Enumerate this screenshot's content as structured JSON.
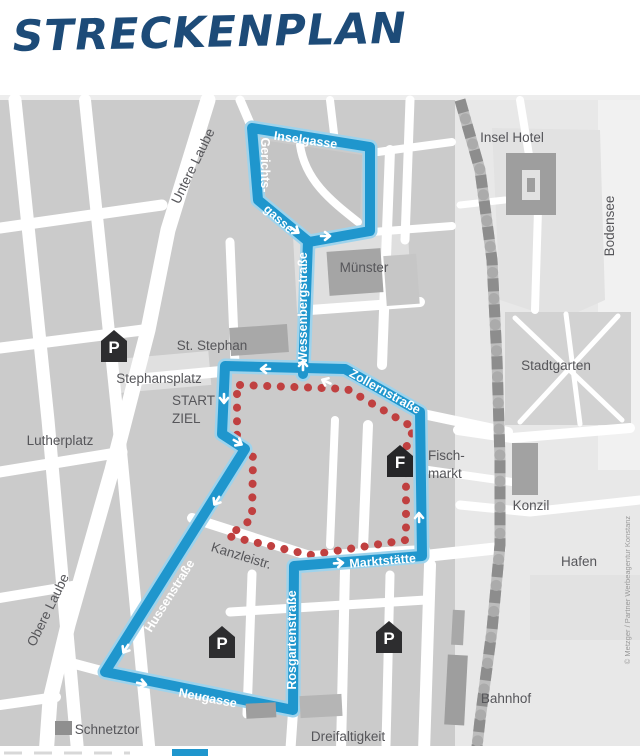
{
  "title": "STRECKENPLAN",
  "credit": "© Metzger / Partner Werbeagentur Konstanz",
  "colors": {
    "title_blue": "#1d4b78",
    "route_blue": "#1f96cd",
    "route_blue_halo": "#9ed3ec",
    "route_red_dots": "#c04040",
    "block_gray": "#cbcbcb",
    "label_gray": "#56565a",
    "marker_black": "#2d2d2f"
  },
  "labels": {
    "untere_laube": "Untere Laube",
    "inselgasse": "Inselgasse",
    "gerichts": "Gerichts-",
    "gasse": "gasse",
    "insel_hotel": "Insel Hotel",
    "bodensee": "Bodensee",
    "muenster": "Münster",
    "wessenbergstrasse": "Wessenbergstraße",
    "st_stephan": "St. Stephan",
    "stephansplatz": "Stephansplatz",
    "start": "START",
    "ziel": "ZIEL",
    "lutherplatz": "Lutherplatz",
    "zollernstrasse": "Zollernstraße",
    "stadtgarten": "Stadtgarten",
    "fischmarkt_line1": "Fisch-",
    "fischmarkt_line2": "markt",
    "konzil": "Konzil",
    "hafen": "Hafen",
    "kanzleistr": "Kanzleistr.",
    "marktstaette": "Marktstätte",
    "hussenstrasse": "Hussenstraße",
    "obere_laube": "Obere Laube",
    "neugasse": "Neugasse",
    "rosgartenstrasse": "Rosgartenstraße",
    "bahnhof": "Bahnhof",
    "dreifaltigkeit": "Dreifaltigkeit",
    "schnetztor": "Schnetztor"
  },
  "markers": {
    "parking": "P",
    "fischmarkt": "F"
  }
}
